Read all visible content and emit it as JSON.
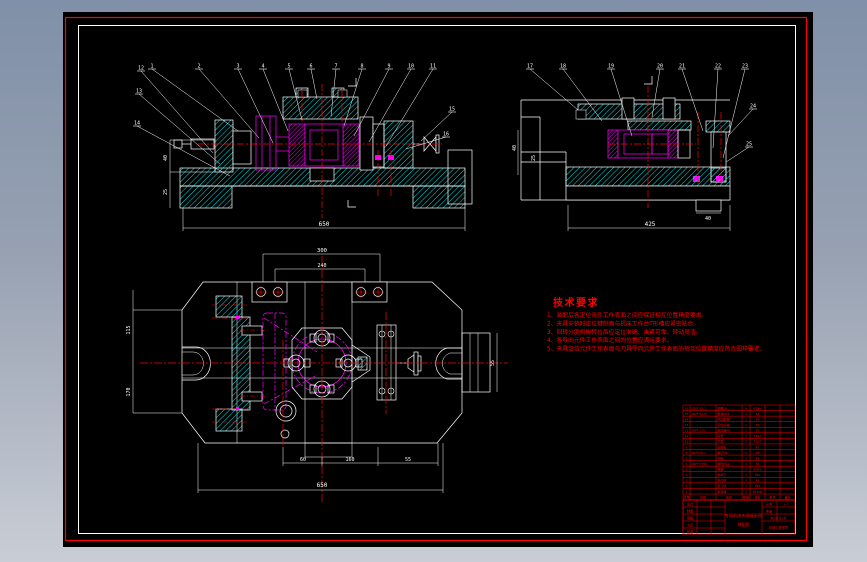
{
  "drawing": {
    "background_top": "#8090a8",
    "background_bottom": "#c9cdd5",
    "canvas_color": "#000000",
    "colors": {
      "outline": "#ffffff",
      "hatch": "#00e8e8",
      "machined_part": "#ff00ff",
      "centerline": "#ff0000",
      "table_lines": "#ff0000"
    }
  },
  "tech_requirements": {
    "title": "技术要求",
    "items": [
      "1、装配后各定位元件工作表面之间应保证相互位置精度要求。",
      "2、夹具安装时定位键侧面与机床工作台T形槽应紧密贴合。",
      "3、回转分度机构转位后应定位准确、夹紧可靠、转动灵活。",
      "4、各导向元件工作表面之间的位置应满足要求。",
      "5、夹具定位元件工作表面与刀具导向元件工作表面的相互位置精度应符合图样要求。"
    ]
  },
  "balloons": {
    "front_top": [
      "1",
      "2",
      "3",
      "4",
      "5",
      "6",
      "7",
      "8",
      "9",
      "10",
      "11"
    ],
    "front_left": [
      "12",
      "13",
      "14"
    ],
    "front_right": [
      "15",
      "16"
    ],
    "side_top": [
      "17",
      "18",
      "19",
      "20",
      "21",
      "22",
      "23"
    ],
    "side_right": [
      "24",
      "25"
    ]
  },
  "dimensions": {
    "front": {
      "overall": "650",
      "left_a": "40",
      "left_b": "25",
      "section": "A"
    },
    "side": {
      "overall": "425",
      "foot": "40",
      "left_a": "40",
      "left_b": "25",
      "section": "I"
    },
    "plan": {
      "top_outer": "300",
      "top_inner": "240",
      "bottom_a": "60",
      "bottom_b": "160",
      "bottom_c": "55",
      "overall": "650",
      "left_a": "115",
      "left_b": "170",
      "right": "55"
    }
  },
  "bom": {
    "headers": [
      "序号",
      "代号",
      "名称",
      "数量",
      "材料",
      "单件",
      "备注"
    ],
    "rows": [
      [
        "16",
        "GB/T 97.1",
        "垫圈16",
        "4",
        "65Mn",
        ""
      ],
      [
        "15",
        "GB/T 6170",
        "螺母M16",
        "4",
        "45",
        ""
      ],
      [
        "14",
        "",
        "开口垫圈",
        "1",
        "45",
        ""
      ],
      [
        "13",
        "",
        "定位心轴",
        "1",
        "45",
        ""
      ],
      [
        "12",
        "GB/T 119",
        "定位销A8",
        "2",
        "35",
        ""
      ],
      [
        "11",
        "",
        "钻套",
        "2",
        "T10A",
        ""
      ],
      [
        "10",
        "",
        "衬套",
        "2",
        "T10A",
        ""
      ],
      [
        "9",
        "",
        "钻模板",
        "1",
        "45",
        ""
      ],
      [
        "8",
        "GB/T 70.1",
        "螺钉M8",
        "6",
        "35",
        ""
      ],
      [
        "7",
        "",
        "压板",
        "2",
        "45",
        ""
      ],
      [
        "6",
        "GB/T 5782",
        "螺栓M12",
        "2",
        "45",
        ""
      ],
      [
        "5",
        "",
        "弹簧",
        "2",
        "65Mn",
        ""
      ],
      [
        "4",
        "",
        "支承钉",
        "4",
        "T8A",
        ""
      ],
      [
        "3",
        "",
        "定位键",
        "2",
        "45",
        ""
      ],
      [
        "2",
        "",
        "对刀块",
        "1",
        "T8A",
        ""
      ],
      [
        "1",
        "",
        "夹具体",
        "1",
        "HT200",
        ""
      ]
    ]
  },
  "title_block": {
    "left_rows": [
      "设计",
      "制图",
      "审核",
      "工艺",
      "批准"
    ],
    "title_line1": "专用机床夹具装配图",
    "title_line2": "装配图",
    "scale_label": "比例",
    "scale_value": "1:1",
    "weight_label": "重量",
    "sheet_label": "共1张 第1张",
    "company": "机械工程学院"
  }
}
